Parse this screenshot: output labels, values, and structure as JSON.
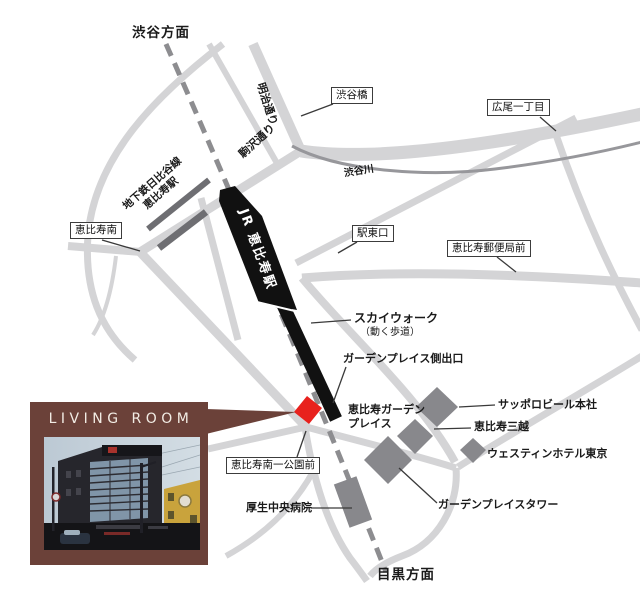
{
  "map": {
    "top_direction": "渋谷方面",
    "bottom_direction": "目黒方面",
    "roads": {
      "meiji_dori": "明治通り",
      "komazawa_dori": "駒沢通り",
      "shibuya_river": "渋谷川"
    },
    "boxed": {
      "shibuyabashi": "渋谷橋",
      "hiroo_itchome": "広尾一丁目",
      "ebisu_minami": "恵比寿南",
      "eki_higashiguchi": "駅東口",
      "ebisu_yubinkyoku_mae": "恵比寿郵便局前",
      "ebisu_minami_koen_mae": "恵比寿南一公園前"
    },
    "stations": {
      "jr_ebisu": "JR 恵比寿駅",
      "subway_line": "地下鉄日比谷線",
      "subway_station": "恵比寿駅"
    },
    "pois": {
      "skywalk": "スカイウォーク",
      "skywalk_note": "（動く歩道）",
      "garden_place_exit": "ガーデンプレイス側出口",
      "garden_place_line1": "恵比寿ガーデン",
      "garden_place_line2": "プレイス",
      "sapporo_beer_hq": "サッポロビール本社",
      "ebisu_mitsukoshi": "恵比寿三越",
      "westin_hotel_tokyo": "ウェスティンホテル東京",
      "garden_place_tower": "ガーデンプレイスタワー",
      "kosei_chuo_hospital": "厚生中央病院"
    }
  },
  "living_room": {
    "title": "LIVING ROOM"
  },
  "colors": {
    "road": "#d4d4d6",
    "river": "#97979b",
    "railway": "#8d8d90",
    "subway_bar": "#6e6e72",
    "building": "#88888c",
    "station_black": "#111111",
    "marker_red": "#e8211d",
    "brand_brown": "#6b4139"
  }
}
